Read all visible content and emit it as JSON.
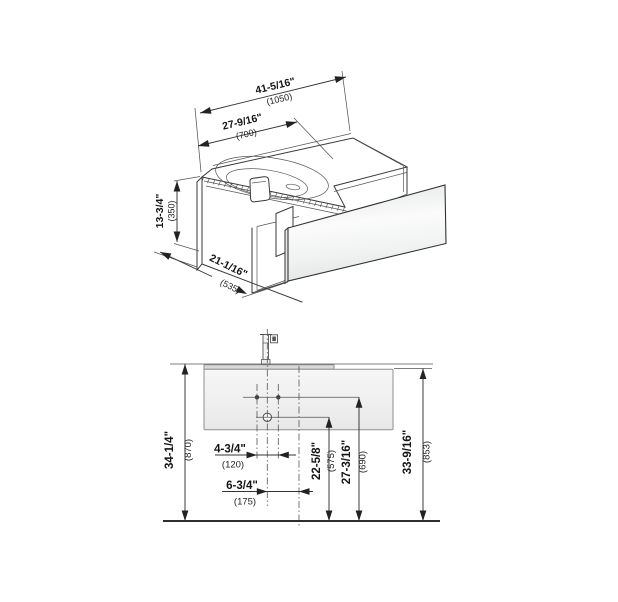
{
  "view_iso": {
    "width_total": {
      "inches": "41-5/16\"",
      "mm": "(1050)"
    },
    "basin_width": {
      "inches": "27-9/16\"",
      "mm": "(700)"
    },
    "height": {
      "inches": "13-3/4\"",
      "mm": "(350)"
    },
    "depth": {
      "inches": "21-1/16\"",
      "mm": "(535)"
    }
  },
  "view_front": {
    "height_to_basin_top": {
      "inches": "34-1/4\"",
      "mm": "(870)"
    },
    "height_to_cabinet_top": {
      "inches": "33-9/16\"",
      "mm": "(853)"
    },
    "faucet_hole_spacing": {
      "inches": "4-3/4\"",
      "mm": "(120)"
    },
    "center_offset": {
      "inches": "6-3/4\"",
      "mm": "(175)"
    },
    "drain_height": {
      "inches": "22-5/8\"",
      "mm": "(575)"
    },
    "faucet_holes_height": {
      "inches": "27-3/16\"",
      "mm": "(690)"
    }
  },
  "colors": {
    "line": "#3a3a3a",
    "panel_fill": "#f2f3f3"
  }
}
